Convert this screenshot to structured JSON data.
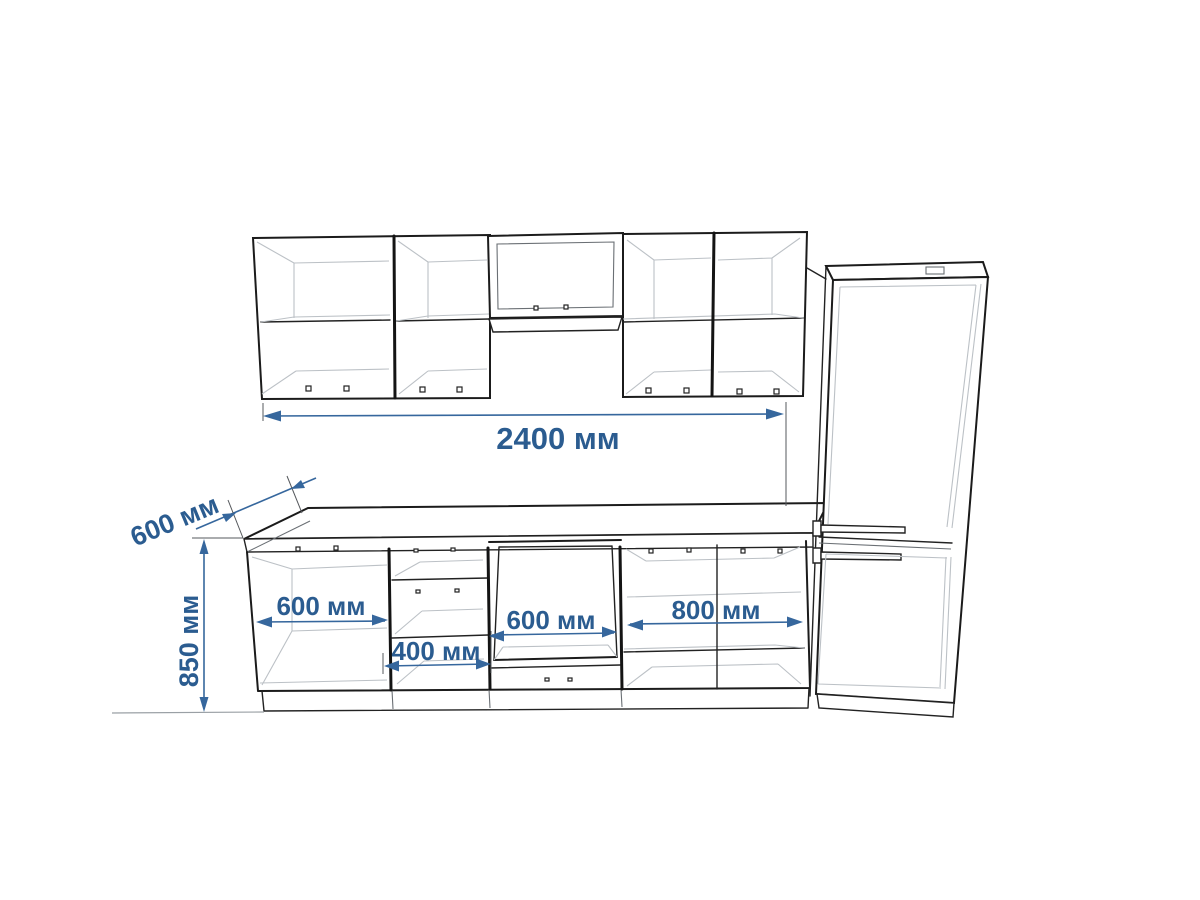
{
  "drawing": {
    "kind": "kitchen-elevation-technical-drawing",
    "units": "мм",
    "colors": {
      "dimension_accent": "#2b5c90",
      "outline": "#1b1b1b",
      "background": "#ffffff"
    },
    "dimensions": {
      "total_width": {
        "text": "2400 мм",
        "value": 2400
      },
      "worktop_depth": {
        "text": "600 мм",
        "value": 600
      },
      "worktop_height": {
        "text": "850 мм",
        "value": 850
      },
      "base_cabinet_left": {
        "text": "600 мм",
        "value": 600
      },
      "drawer_cabinet": {
        "text": "400 мм",
        "value": 400
      },
      "oven_cabinet": {
        "text": "600 мм",
        "value": 600
      },
      "base_cabinet_right": {
        "text": "800 мм",
        "value": 800
      }
    }
  }
}
